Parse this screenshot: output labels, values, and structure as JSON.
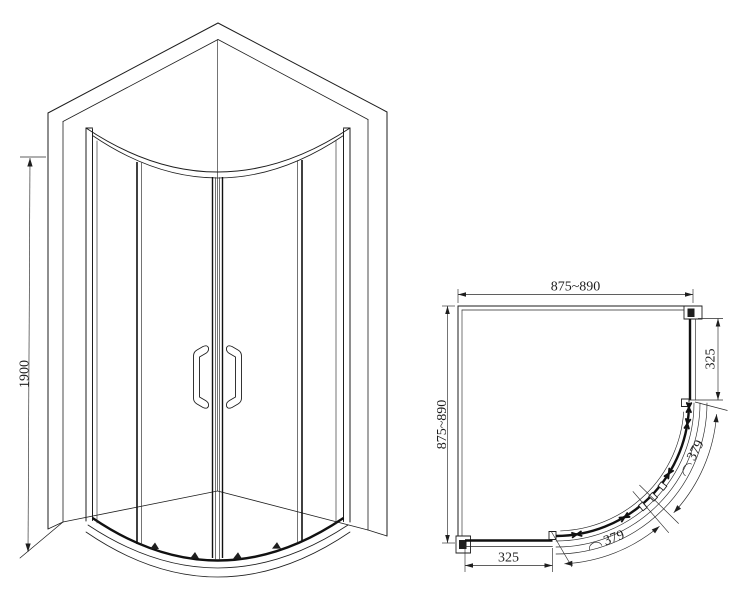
{
  "drawing": {
    "background": "#ffffff",
    "line_color": "#1e1e1e"
  },
  "front_view": {
    "height_dim": "1900"
  },
  "plan_view": {
    "width_dim_top": "875~890",
    "width_dim_left": "875~890",
    "panel_dim_right": "325",
    "panel_dim_bottom": "325",
    "door_arc_dim_upper": "379",
    "door_arc_dim_lower": "379"
  }
}
